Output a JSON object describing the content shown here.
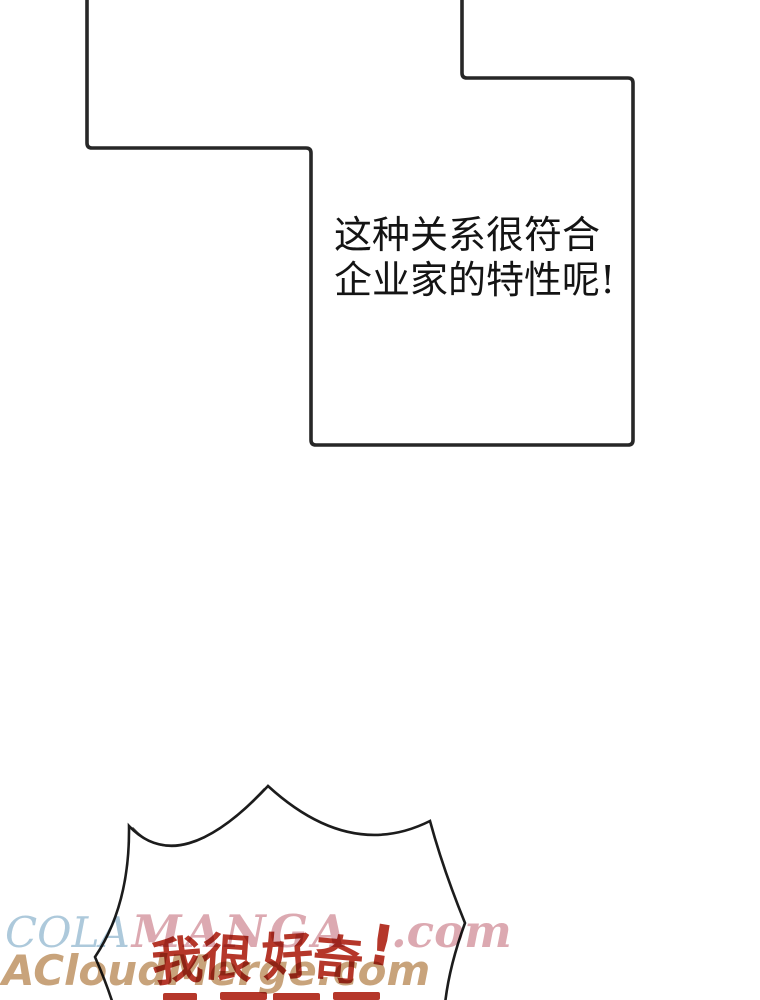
{
  "panel": {
    "line1": "这种关系很符合",
    "line2": "企业家的特性呢!",
    "outline_color": "#272727"
  },
  "burst_bubble": {
    "shout_line": "我很好奇!",
    "shout_color": "#b5372a",
    "outline_color": "#1c1c1c",
    "partial_second_line_glyph_tops": 4
  },
  "watermarks": {
    "line1_part1": "COLA",
    "line1_part1_color": "#a9c7da",
    "line1_part2": "MANGA",
    "line1_part2_color": "#d4949e",
    "line1_part3": ".com",
    "line2_text": "ACloudMerge.com",
    "line2_color": "#c29a6d"
  }
}
